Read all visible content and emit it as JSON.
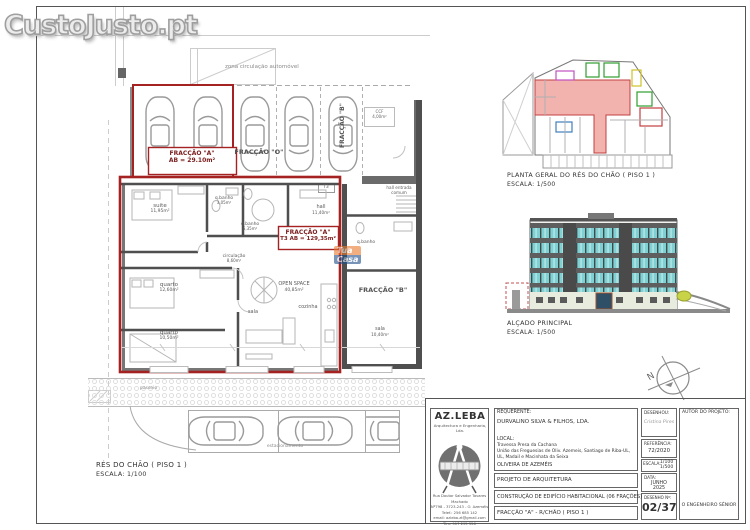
{
  "watermark": {
    "site": "CustoJusto.pt",
    "agency_top": "Tua",
    "agency_bottom": "Casa"
  },
  "plan": {
    "zona": "zona circulação automóvel",
    "garage_box_title": "FRACÇÃO \"A\"",
    "garage_box_area": "AB = 29.10m²",
    "fraccao_o": "FRACÇÃO \"O\"",
    "fraccao_b_garage": "FRACÇÃO \"B\"",
    "ccf_line1": "CCF",
    "ccf_line2": "4,00m²",
    "hall_entrada_line1": "hall entrada",
    "hall_entrada_line2": "comum",
    "t3_tag": "T3",
    "apt_box_title": "FRACÇÃO \"A\"",
    "apt_box_area": "T3  AB = 129,35m²",
    "rooms": [
      {
        "name": "suite",
        "area": "11,95m²"
      },
      {
        "name": "q.banho",
        "area": "3,05m²"
      },
      {
        "name": "q.banho",
        "area": "6,35m²"
      },
      {
        "name": "hall",
        "area": "11,40m²"
      },
      {
        "name": "circulação",
        "area": "8,60m²"
      },
      {
        "name": "quarto",
        "area": "12,60m²"
      },
      {
        "name": "OPEN SPACE",
        "area": "40,85m²"
      },
      {
        "name": "cozinha",
        "area": ""
      },
      {
        "name": "sala",
        "area": ""
      },
      {
        "name": "quarto",
        "area": "10,50m²"
      },
      {
        "name": "q.banho",
        "area": ""
      },
      {
        "name": "sala",
        "area": "10,40m²"
      }
    ],
    "fraccao_b_apt": "FRACÇÃO \"B\"",
    "passeio": "passeio",
    "estacionamento": "estacionamento",
    "caption_title": "RÉS DO CHÃO ( PISO 1 )",
    "caption_scale": "ESCALA: 1/100"
  },
  "site_plan": {
    "caption_title": "PLANTA GERAL DO RÉS DO CHÃO ( PISO 1 )",
    "caption_scale": "ESCALA: 1/500"
  },
  "elevation": {
    "caption_title": "ALÇADO PRINCIPAL",
    "caption_scale": "ESCALA: 1/500"
  },
  "north": "N",
  "title_block": {
    "firm_name": "AZ.LEBA",
    "firm_subtitle": "Arquitectura e Engenharia, Lda.",
    "firm_address": [
      "Rua Doutor Salvador Tavares Machado",
      "Nº798 - 3723-243 - O. Azeméis",
      "Telef.: 256 685 142",
      "email: azleba.zt@gmail.com",
      "Tlm: 917 295 556"
    ],
    "requerente_label": "REQUERENTE:",
    "requerente": "DURVALINO SILVA & FILHOS, LDA.",
    "local_label": "LOCAL:",
    "local_line1": "Travessa Presa da Cachana",
    "local_line2": "União das Freguesias de Oliv. Azemeis, Santiago de Riba-UL,",
    "local_line3": "UL, Madail e Macinhata da Seixa",
    "local_line4": "OLIVEIRA DE AZEMÉIS",
    "projeto": "PROJETO DE ARQUITETURA",
    "construcao": "CONSTRUÇÃO DE EDIFÍCIO HABITACIONAL (06 FRAÇÕES)",
    "folha": "FRACÇÃO \"A\" - R/CHÃO ( PISO 1 )",
    "desenhou_label": "DESENHOU:",
    "desenhou": "Cristina Pires",
    "referencia_label": "REFERÊNCIA:",
    "referencia": "72/2020",
    "escala_label": "ESCALA:",
    "escala_1": "1/100",
    "escala_2": "1/500",
    "data_label": "DATA:",
    "data_1": "JUNHO",
    "data_2": "2025",
    "desenho_label": "DESENHO Nº:",
    "desenho_num": "02/37",
    "autor_label": "AUTOR DO PROJETO:",
    "autor_assinatura": "O ENGENHEIRO SÉNIOR"
  },
  "colors": {
    "highlight_red": "#a42222",
    "site_pink": "#f2b2ae",
    "elevation_teal": "#7fd0d2",
    "band_grey": "#5e5e5e",
    "ground_floor": "#e7ecdf"
  }
}
